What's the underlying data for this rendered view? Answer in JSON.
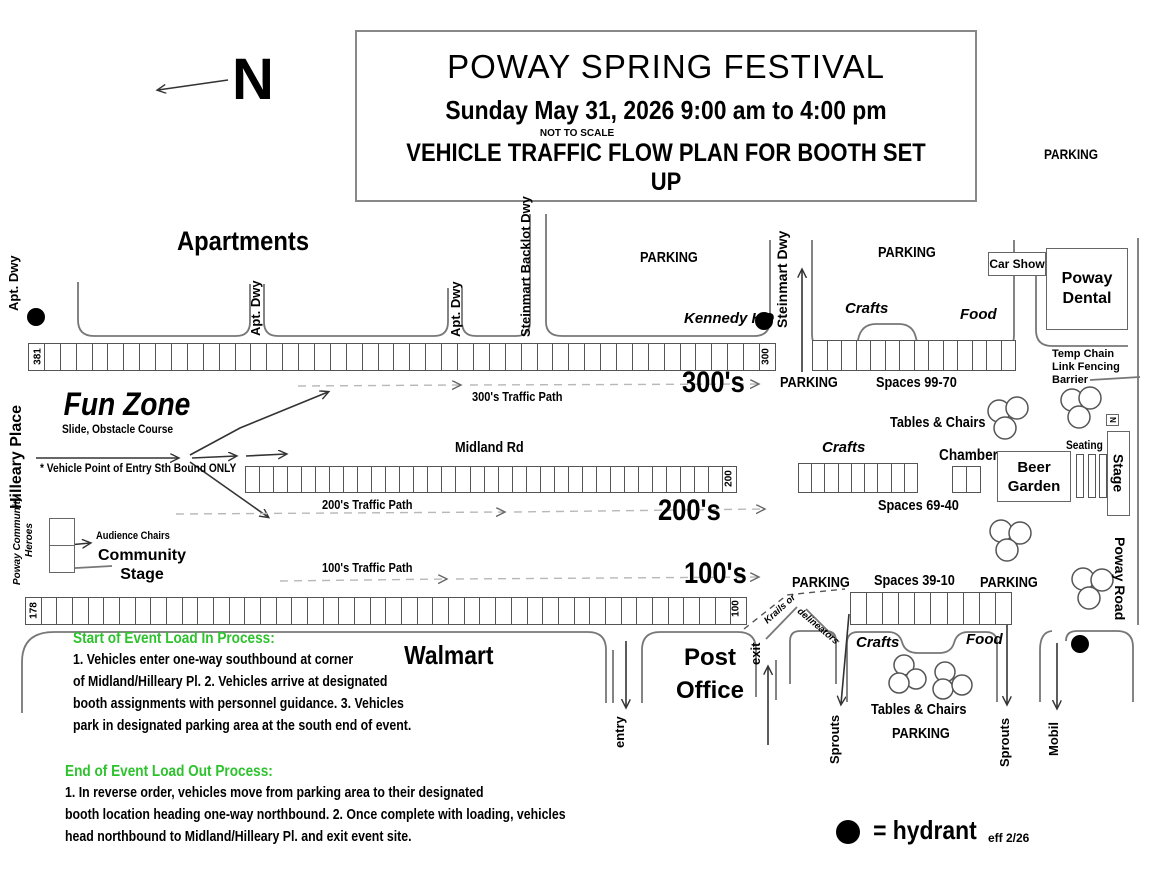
{
  "colors": {
    "heading_green": "#2ec22e",
    "ink": "#000000",
    "road_gray": "#777777",
    "dash_gray": "#b8b8b8"
  },
  "title_box": {
    "line1": "POWAY SPRING FESTIVAL",
    "line2": "Sunday May 31, 2026  9:00 am to 4:00 pm",
    "scale_note": "NOT TO SCALE",
    "line3": "VEHICLE TRAFFIC FLOW PLAN FOR BOOTH SET UP"
  },
  "compass": {
    "label": "N"
  },
  "labels": {
    "parking": "PARKING",
    "crafts": "Crafts",
    "food": "Food",
    "tables_chairs": "Tables & Chairs",
    "apartments": "Apartments",
    "walmart": "Walmart",
    "post_office": "Post\nOffice",
    "poway_dental": "Poway\nDental",
    "car_show": "Car Show",
    "kennedy_hq": "Kennedy HQ",
    "chamber": "Chamber",
    "beer_garden": "Beer\nGarden",
    "seating": "Seating",
    "stage": "Stage",
    "n_marker": "N",
    "temp_chain_fence": "Temp Chain\nLink Fencing\nBarrier",
    "krails_line1": "Krails or",
    "krails_line2": "delineators"
  },
  "streets": {
    "apt_dwy": "Apt. Dwy",
    "steinmart_backlot_dwy": "Steinmart Backlot Dwy",
    "steinmart_dwy": "Steinmart Dwy",
    "hilleary_place": "Hilleary Place",
    "midland_rd": "Midland Rd",
    "poway_road": "Poway Road",
    "entry": "entry",
    "exit": "exit",
    "sprouts": "Sprouts",
    "mobil": "Mobil"
  },
  "fun_zone": {
    "title": "Fun Zone",
    "subtitle": "Slide, Obstacle Course",
    "entry_note": "* Vehicle Point of Entry Sth Bound ONLY"
  },
  "community": {
    "heroes": "Poway Community\nHeroes",
    "audience_chairs": "Audience Chairs",
    "stage_label": "Community\nStage"
  },
  "rows": {
    "r300": {
      "start_num": "381",
      "end_num": "300",
      "cells": 47,
      "big_label": "300's",
      "path_label": "300's Traffic Path"
    },
    "r200": {
      "end_num": "200",
      "cells": 35,
      "big_label": "200's",
      "path_label": "200's Traffic Path"
    },
    "r100": {
      "start_num": "178",
      "end_num": "100",
      "cells": 46,
      "big_label": "100's",
      "path_label": "100's Traffic Path"
    },
    "p9970": {
      "cells": 14,
      "label": "Spaces 99-70"
    },
    "p6940": {
      "cells": 9,
      "label": "Spaces 69-40"
    },
    "p3910": {
      "cells": 10,
      "label": "Spaces 39-10"
    },
    "chamber_cells": 2
  },
  "legend": {
    "hydrant_text": "= hydrant",
    "eff": "eff 2/26"
  },
  "load_in": {
    "heading": "Start of Event Load In Process:",
    "lines": [
      "1. Vehicles enter one-way southbound at corner",
      "of Midland/Hilleary Pl.  2. Vehicles arrive at designated",
      "booth assignments with personnel guidance. 3. Vehicles",
      "park in designated parking area at the south end of event."
    ]
  },
  "load_out": {
    "heading": "End of Event Load Out Process:",
    "lines": [
      "1. In reverse order, vehicles move from parking area to their designated",
      "booth location heading one-way northbound. 2. Once complete with loading, vehicles",
      "head northbound to Midland/Hilleary Pl. and exit event site."
    ]
  }
}
